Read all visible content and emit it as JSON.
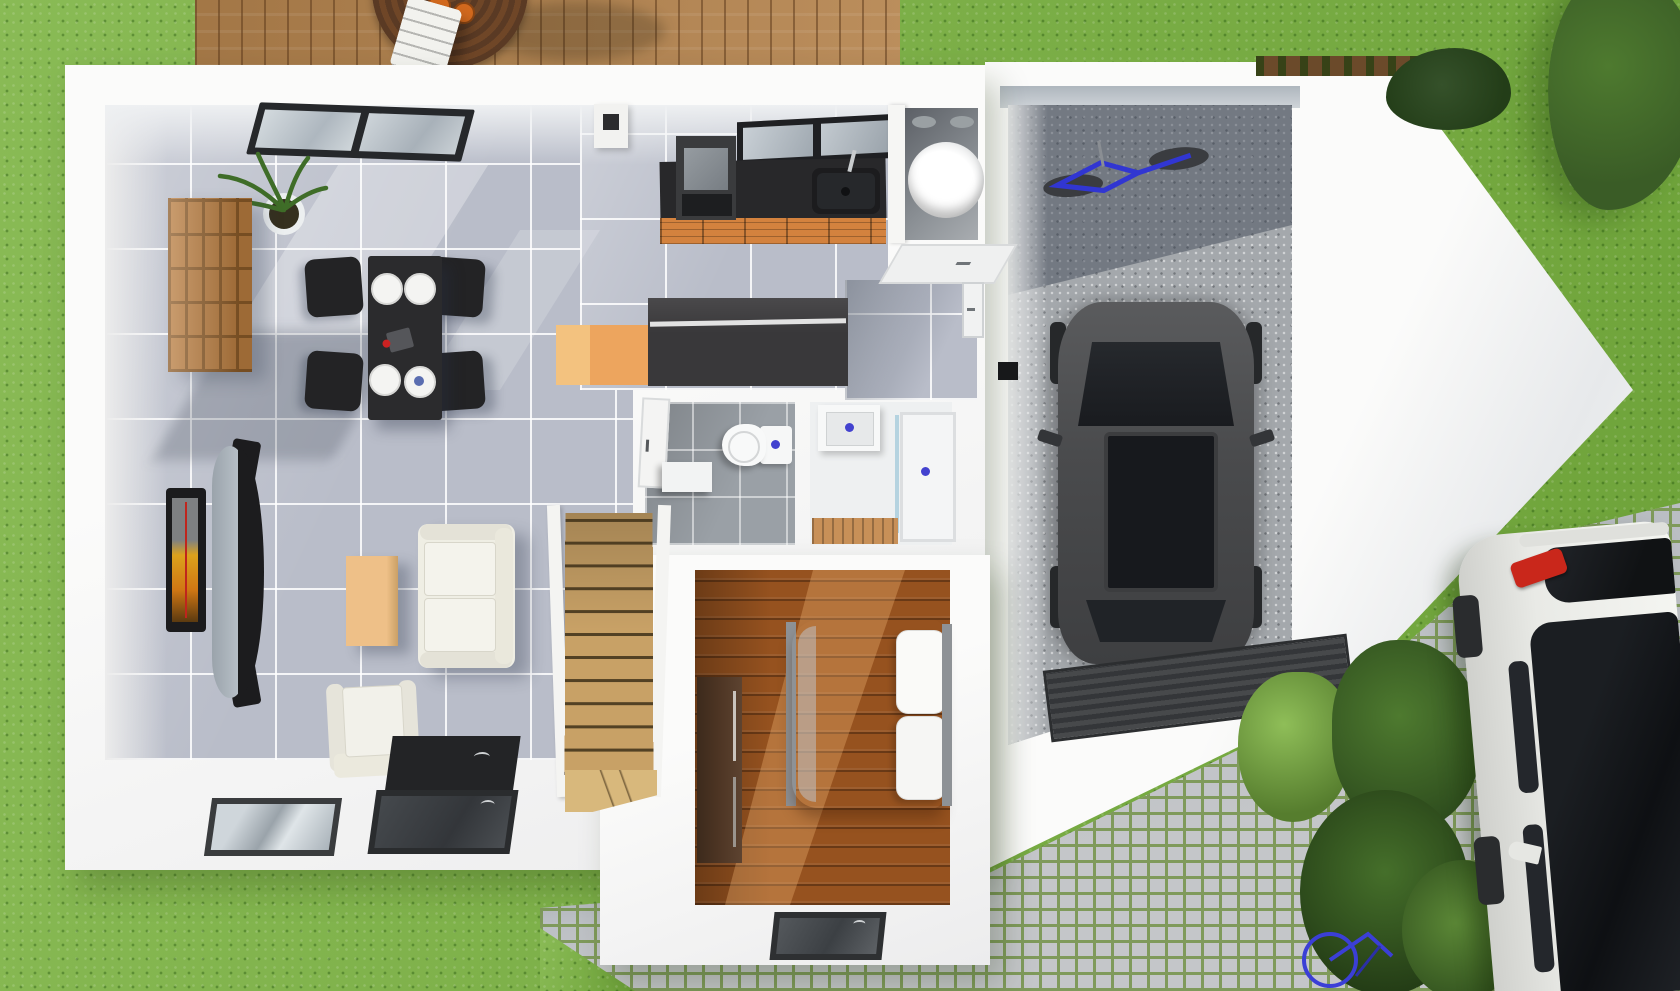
{
  "meta": {
    "title": "3D top-down floor plan render of a single-storey house with garage",
    "view": "dollhouse overhead 3D render",
    "has_text": false
  },
  "palette": {
    "grass": "#7cb342",
    "cobble_stone": "#c4c6c9",
    "cobble_moss": "#7f9a5b",
    "deck_wood": "#b5844e",
    "wall_white": "#f7f7f5",
    "tile": "#b9bdc9",
    "wc_tile": "#9aa0a6",
    "wood_floor": "#96521f",
    "stair_wood": "#c8a166",
    "concrete": "#a4a8ac",
    "counter_black": "#28282a",
    "cabinet_orange": "#d3823e",
    "island_orange": "#eda55e",
    "island_dark": "#39383a",
    "sofa_cream": "#efeee4",
    "table_black": "#2b2b2d",
    "car_dark": "#4a4b4d",
    "car_glass": "#17191d",
    "garage_door": "#3b3d3f",
    "white_car": "#e9eae6",
    "tail_red": "#c9271b",
    "bike_blue": "#3136d2",
    "foliage": "#3a5c26",
    "plant_green": "#3f6d28",
    "fixture_blue": "#4342cf",
    "tv_orange": "#dca21c",
    "wardrobe": "#4c3423"
  },
  "rooms": [
    {
      "name": "living-dining-room",
      "floor": "grey tile",
      "furniture": [
        "dining table",
        "4 black chairs",
        "plates",
        "cube shelf",
        "potted plant",
        "wall tv",
        "curved media console",
        "coffee table",
        "sofa",
        "armchair",
        "black rug",
        "sliding glass window"
      ]
    },
    {
      "name": "kitchen",
      "floor": "grey tile",
      "furniture": [
        "black countertop",
        "sink",
        "faucet",
        "stove with hood",
        "orange cabinets",
        "kitchen island",
        "window",
        "chimney duct"
      ]
    },
    {
      "name": "utility-room",
      "furniture": [
        "water heater cylinder",
        "service door"
      ]
    },
    {
      "name": "wc",
      "floor": "dark grey tile",
      "furniture": [
        "toilet",
        "bin",
        "door"
      ]
    },
    {
      "name": "shower-room",
      "furniture": [
        "vanity sink",
        "shower tray",
        "wooden mat"
      ]
    },
    {
      "name": "stairs",
      "furniture": [
        "wooden staircase with winder"
      ]
    },
    {
      "name": "bedroom",
      "floor": "wood planks",
      "furniture": [
        "double bed",
        "pillows",
        "wardrobe",
        "front window"
      ]
    },
    {
      "name": "garage",
      "floor": "concrete",
      "furniture": [
        "dark grey car",
        "blue bicycle",
        "ribbed garage door"
      ]
    }
  ],
  "outdoor": [
    {
      "name": "deck-terrace",
      "items": [
        "round wooden table",
        "orange plates",
        "white chair"
      ]
    },
    {
      "name": "lawn",
      "items": [
        "grass",
        "trees",
        "hedge planter"
      ]
    },
    {
      "name": "driveway",
      "items": [
        "cobblestone paving",
        "shrub row",
        "blue bicycle"
      ]
    },
    {
      "name": "parked-white-car",
      "items": [
        "red tail light",
        "dark panoramic roof",
        "side mirror"
      ]
    }
  ]
}
